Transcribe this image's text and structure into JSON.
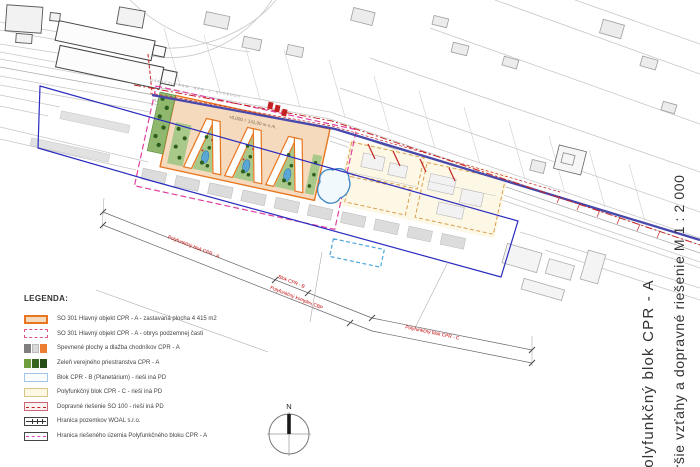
{
  "drawing": {
    "project_title": "Polyfunkčný blok CPR - A",
    "sheet_title": "Širšie vzťahy a dopravné riešenie M 1 : 2 000"
  },
  "map": {
    "elevation_label": "+0,000 = 141,00 m n.m.",
    "street_label": "NÁBREŽIE ARM. GEN. L. SVOBODU",
    "building_label": "VÚVH",
    "compass_label": "N",
    "dimension_labels": {
      "block_a": "Polyfunkčný blok CPR - A",
      "block_b": "Blok CPR - B",
      "complex_cbp": "Polyfunkčný komplex CBP",
      "block_c": "Polyfunkčný blok CPR - C"
    }
  },
  "legend": {
    "title": "LEGENDA:",
    "items": [
      {
        "label": "SO 301 Hlavný objekt CPR - A - zastavaná plocha 4 415 m2",
        "swatch": "main-object"
      },
      {
        "label": "SO 301 Hlavný objekt CPR - A - obrys podzemnej časti",
        "swatch": "underground-outline"
      },
      {
        "label": "Spevnené plochy a dlažba chodníkov CPR - A",
        "swatch": "paved-areas"
      },
      {
        "label": "Zeleň verejného priestranstva CPR - A",
        "swatch": "public-greenery"
      },
      {
        "label": "Blok CPR - B (Planetárium) - rieši iná PD",
        "swatch": "block-b"
      },
      {
        "label": "Polyfunkčný blok CPR - C - rieši iná PD",
        "swatch": "block-c"
      },
      {
        "label": "Dopravné riešenie SO 100 - rieši iná PD",
        "swatch": "traffic-design"
      },
      {
        "label": "Hranica pozemkov WOAL s.r.o.",
        "swatch": "parcel-boundary"
      },
      {
        "label": "Hranica riešeného územia Polyfunkčného bloku CPR - A",
        "swatch": "site-boundary"
      }
    ]
  },
  "colors": {
    "main_object_fill": "#F5DABE",
    "main_object_stroke": "#E8761E",
    "underground_outline": "#E0558A",
    "paved_dark": "#7F7F7F",
    "paved_light": "#D9D9D9",
    "paved_orange": "#ED7D31",
    "greenery_dark": "#2E5E1E",
    "block_b_stroke": "#9FC5E8",
    "block_c_fill": "#FDF8E4",
    "traffic_red": "#C42222",
    "site_boundary_magenta": "#E0409E",
    "ownership_boundary_blue": "#2B2BBF",
    "road_axis_indigo": "#4848AC",
    "dimension_label_red": "#C00000"
  }
}
